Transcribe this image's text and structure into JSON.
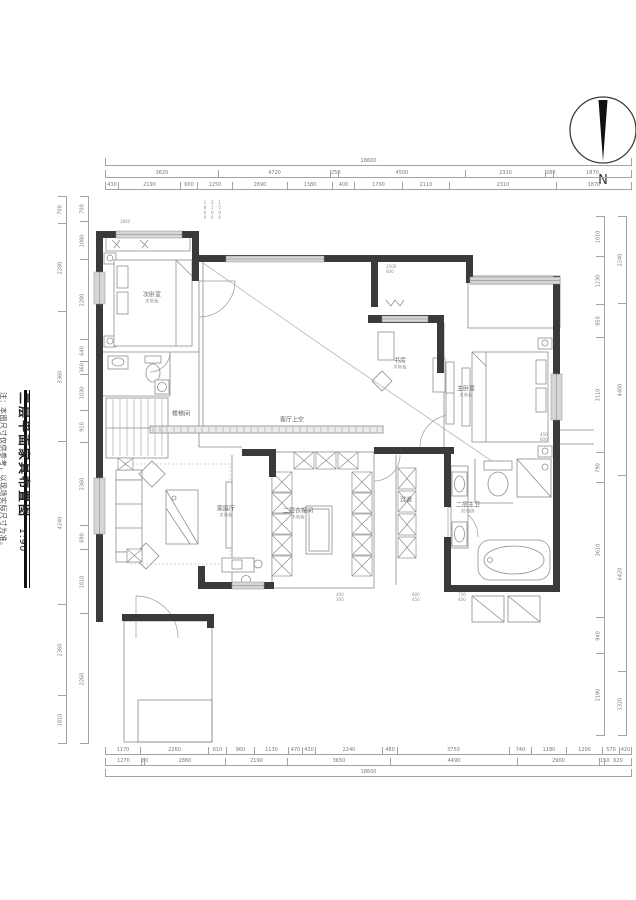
{
  "title_block": {
    "title": "二层平面家具布置图",
    "scale": "1:90",
    "note": "注：本图尺寸仅供参考，以现场实际尺寸为准。"
  },
  "compass": {
    "label": "N"
  },
  "colors": {
    "wall": "#3a3a3a",
    "line": "#8a8a8a",
    "window_fill": "#d6d6d6",
    "dim_text": "#7a7a7a"
  },
  "room_labels": [
    {
      "id": "nw-bedroom",
      "x": 152,
      "y": 298,
      "name": "次卧室",
      "sub": "木地板"
    },
    {
      "id": "stair",
      "x": 181,
      "y": 414,
      "name": "楼梯间",
      "sub": ""
    },
    {
      "id": "void",
      "x": 292,
      "y": 420,
      "name": "客厅上空",
      "sub": ""
    },
    {
      "id": "study",
      "x": 400,
      "y": 364,
      "name": "书房",
      "sub": "木地板"
    },
    {
      "id": "master-bedroom",
      "x": 466,
      "y": 392,
      "name": "主卧室",
      "sub": "木地板"
    },
    {
      "id": "master-bath",
      "x": 468,
      "y": 508,
      "name": "二层主卫",
      "sub": "防滑砖"
    },
    {
      "id": "closet",
      "x": 298,
      "y": 514,
      "name": "二层衣帽间",
      "sub": "木地板"
    },
    {
      "id": "family",
      "x": 226,
      "y": 512,
      "name": "家庭厅",
      "sub": "木地板"
    },
    {
      "id": "corridor",
      "x": 406,
      "y": 500,
      "name": "过道",
      "sub": ""
    }
  ],
  "callouts": [
    {
      "id": "c1",
      "x": 202,
      "y": 200,
      "vertical": true,
      "lines": [
        "1800",
        "2100",
        "1500"
      ]
    },
    {
      "id": "c2",
      "x": 386,
      "y": 264,
      "vertical": false,
      "lines": [
        "1500",
        "600"
      ]
    },
    {
      "id": "c3",
      "x": 540,
      "y": 432,
      "vertical": false,
      "lines": [
        "450",
        "600"
      ]
    },
    {
      "id": "c4",
      "x": 336,
      "y": 592,
      "vertical": false,
      "lines": [
        "400",
        "300"
      ]
    },
    {
      "id": "c5",
      "x": 412,
      "y": 592,
      "vertical": false,
      "lines": [
        "600",
        "450"
      ]
    },
    {
      "id": "c6",
      "x": 458,
      "y": 592,
      "vertical": false,
      "lines": [
        "750",
        "400"
      ]
    },
    {
      "id": "c7",
      "x": 120,
      "y": 219,
      "vertical": false,
      "lines": [
        "1800"
      ]
    }
  ],
  "dimensions": {
    "rows": [
      {
        "id": "top-total",
        "o": "h",
        "x": 105,
        "y": 158,
        "len": 527,
        "segs": [
          {
            "v": "18600",
            "w": 527
          }
        ]
      },
      {
        "id": "top-mid",
        "o": "h",
        "x": 105,
        "y": 170,
        "len": 527,
        "segs": [
          {
            "v": "3620",
            "w": 113
          },
          {
            "v": "4720",
            "w": 112
          },
          {
            "v": "250",
            "w": 8
          },
          {
            "v": "4500",
            "w": 127
          },
          {
            "v": "2310",
            "w": 80
          },
          {
            "v": "280",
            "w": 8
          },
          {
            "v": "1870",
            "w": 79
          }
        ]
      },
      {
        "id": "top-inner",
        "o": "h",
        "x": 105,
        "y": 182,
        "len": 527,
        "segs": [
          {
            "v": "430",
            "w": 13
          },
          {
            "v": "2190",
            "w": 62
          },
          {
            "v": "600",
            "w": 17
          },
          {
            "v": "1250",
            "w": 35
          },
          {
            "v": "2690",
            "w": 55
          },
          {
            "v": "1380",
            "w": 45
          },
          {
            "v": "400",
            "w": 22
          },
          {
            "v": "1790",
            "w": 48
          },
          {
            "v": "2110",
            "w": 47
          },
          {
            "v": "2310",
            "w": 107
          },
          {
            "v": "1870",
            "w": 76
          }
        ]
      },
      {
        "id": "bottom-inner",
        "o": "h",
        "x": 105,
        "y": 747,
        "len": 527,
        "segs": [
          {
            "v": "1170",
            "w": 35
          },
          {
            "v": "2260",
            "w": 68
          },
          {
            "v": "610",
            "w": 18
          },
          {
            "v": "960",
            "w": 28
          },
          {
            "v": "1130",
            "w": 34
          },
          {
            "v": "470",
            "w": 14
          },
          {
            "v": "430",
            "w": 13
          },
          {
            "v": "2240",
            "w": 67
          },
          {
            "v": "480",
            "w": 15
          },
          {
            "v": "3750",
            "w": 112
          },
          {
            "v": "740",
            "w": 22
          },
          {
            "v": "1180",
            "w": 35
          },
          {
            "v": "1200",
            "w": 36
          },
          {
            "v": "570",
            "w": 17
          },
          {
            "v": "420",
            "w": 13
          }
        ]
      },
      {
        "id": "bottom-mid",
        "o": "h",
        "x": 105,
        "y": 758,
        "len": 527,
        "segs": [
          {
            "v": "1270",
            "w": 36
          },
          {
            "v": "80",
            "w": 3
          },
          {
            "v": "2860",
            "w": 81
          },
          {
            "v": "2190",
            "w": 62
          },
          {
            "v": "3650",
            "w": 103
          },
          {
            "v": "4490",
            "w": 127
          },
          {
            "v": "2900",
            "w": 82
          },
          {
            "v": "150",
            "w": 5
          },
          {
            "v": "620",
            "w": 28
          }
        ]
      },
      {
        "id": "bottom-total",
        "o": "h",
        "x": 105,
        "y": 769,
        "len": 527,
        "segs": [
          {
            "v": "18600",
            "w": 527
          }
        ]
      },
      {
        "id": "left-outer",
        "o": "v",
        "x": 58,
        "y": 196,
        "len": 548,
        "segs": [
          {
            "v": "700",
            "w": 27
          },
          {
            "v": "2280",
            "w": 88
          },
          {
            "v": "3360",
            "w": 130
          },
          {
            "v": "4240",
            "w": 163
          },
          {
            "v": "2360",
            "w": 91
          },
          {
            "v": "1810",
            "w": 49
          }
        ]
      },
      {
        "id": "left-inner",
        "o": "v",
        "x": 80,
        "y": 196,
        "len": 548,
        "segs": [
          {
            "v": "700",
            "w": 25
          },
          {
            "v": "1080",
            "w": 38
          },
          {
            "v": "2280",
            "w": 80
          },
          {
            "v": "640",
            "w": 22
          },
          {
            "v": "360",
            "w": 13
          },
          {
            "v": "1030",
            "w": 36
          },
          {
            "v": "910",
            "w": 32
          },
          {
            "v": "2360",
            "w": 83
          },
          {
            "v": "690",
            "w": 24
          },
          {
            "v": "1810",
            "w": 64
          },
          {
            "v": "2260",
            "w": 131
          }
        ]
      },
      {
        "id": "right-inner",
        "o": "v",
        "x": 596,
        "y": 216,
        "len": 520,
        "segs": [
          {
            "v": "1010",
            "w": 40
          },
          {
            "v": "1230",
            "w": 48
          },
          {
            "v": "850",
            "w": 33
          },
          {
            "v": "3110",
            "w": 115
          },
          {
            "v": "790",
            "w": 30
          },
          {
            "v": "3610",
            "w": 135
          },
          {
            "v": "940",
            "w": 36
          },
          {
            "v": "2190",
            "w": 83
          }
        ]
      },
      {
        "id": "right-outer",
        "o": "v",
        "x": 618,
        "y": 216,
        "len": 520,
        "segs": [
          {
            "v": "2240",
            "w": 87
          },
          {
            "v": "4400",
            "w": 172
          },
          {
            "v": "6420",
            "w": 196
          },
          {
            "v": "1320",
            "w": 65
          }
        ]
      }
    ]
  }
}
